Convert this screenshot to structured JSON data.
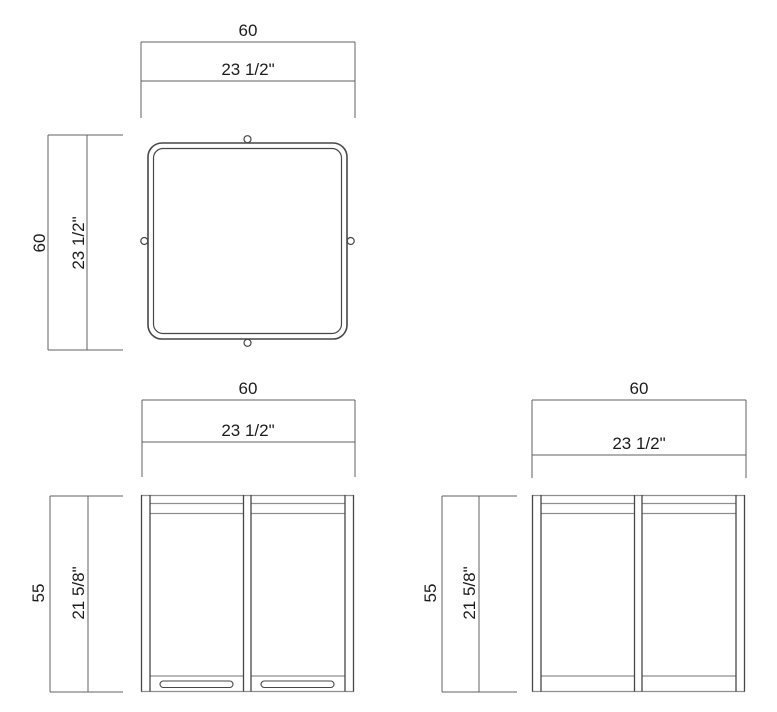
{
  "views": {
    "top": {
      "name": "top view",
      "width": {
        "units": "60",
        "inches": "23 1/2\""
      },
      "height": {
        "units": "60",
        "inches": "23 1/2\""
      }
    },
    "front": {
      "name": "front elevation",
      "width": {
        "units": "60",
        "inches": "23 1/2\""
      },
      "height": {
        "units": "55",
        "inches": "21 5/8\""
      }
    },
    "side": {
      "name": "side elevation",
      "width": {
        "units": "60",
        "inches": "23 1/2\""
      },
      "height": {
        "units": "55",
        "inches": "21 5/8\""
      }
    }
  },
  "colors": {
    "background": "#ffffff",
    "object_line": "#474747",
    "object_line_light": "#8e8e8e",
    "dimension_line": "#606060",
    "text": "#1c1c1c"
  }
}
